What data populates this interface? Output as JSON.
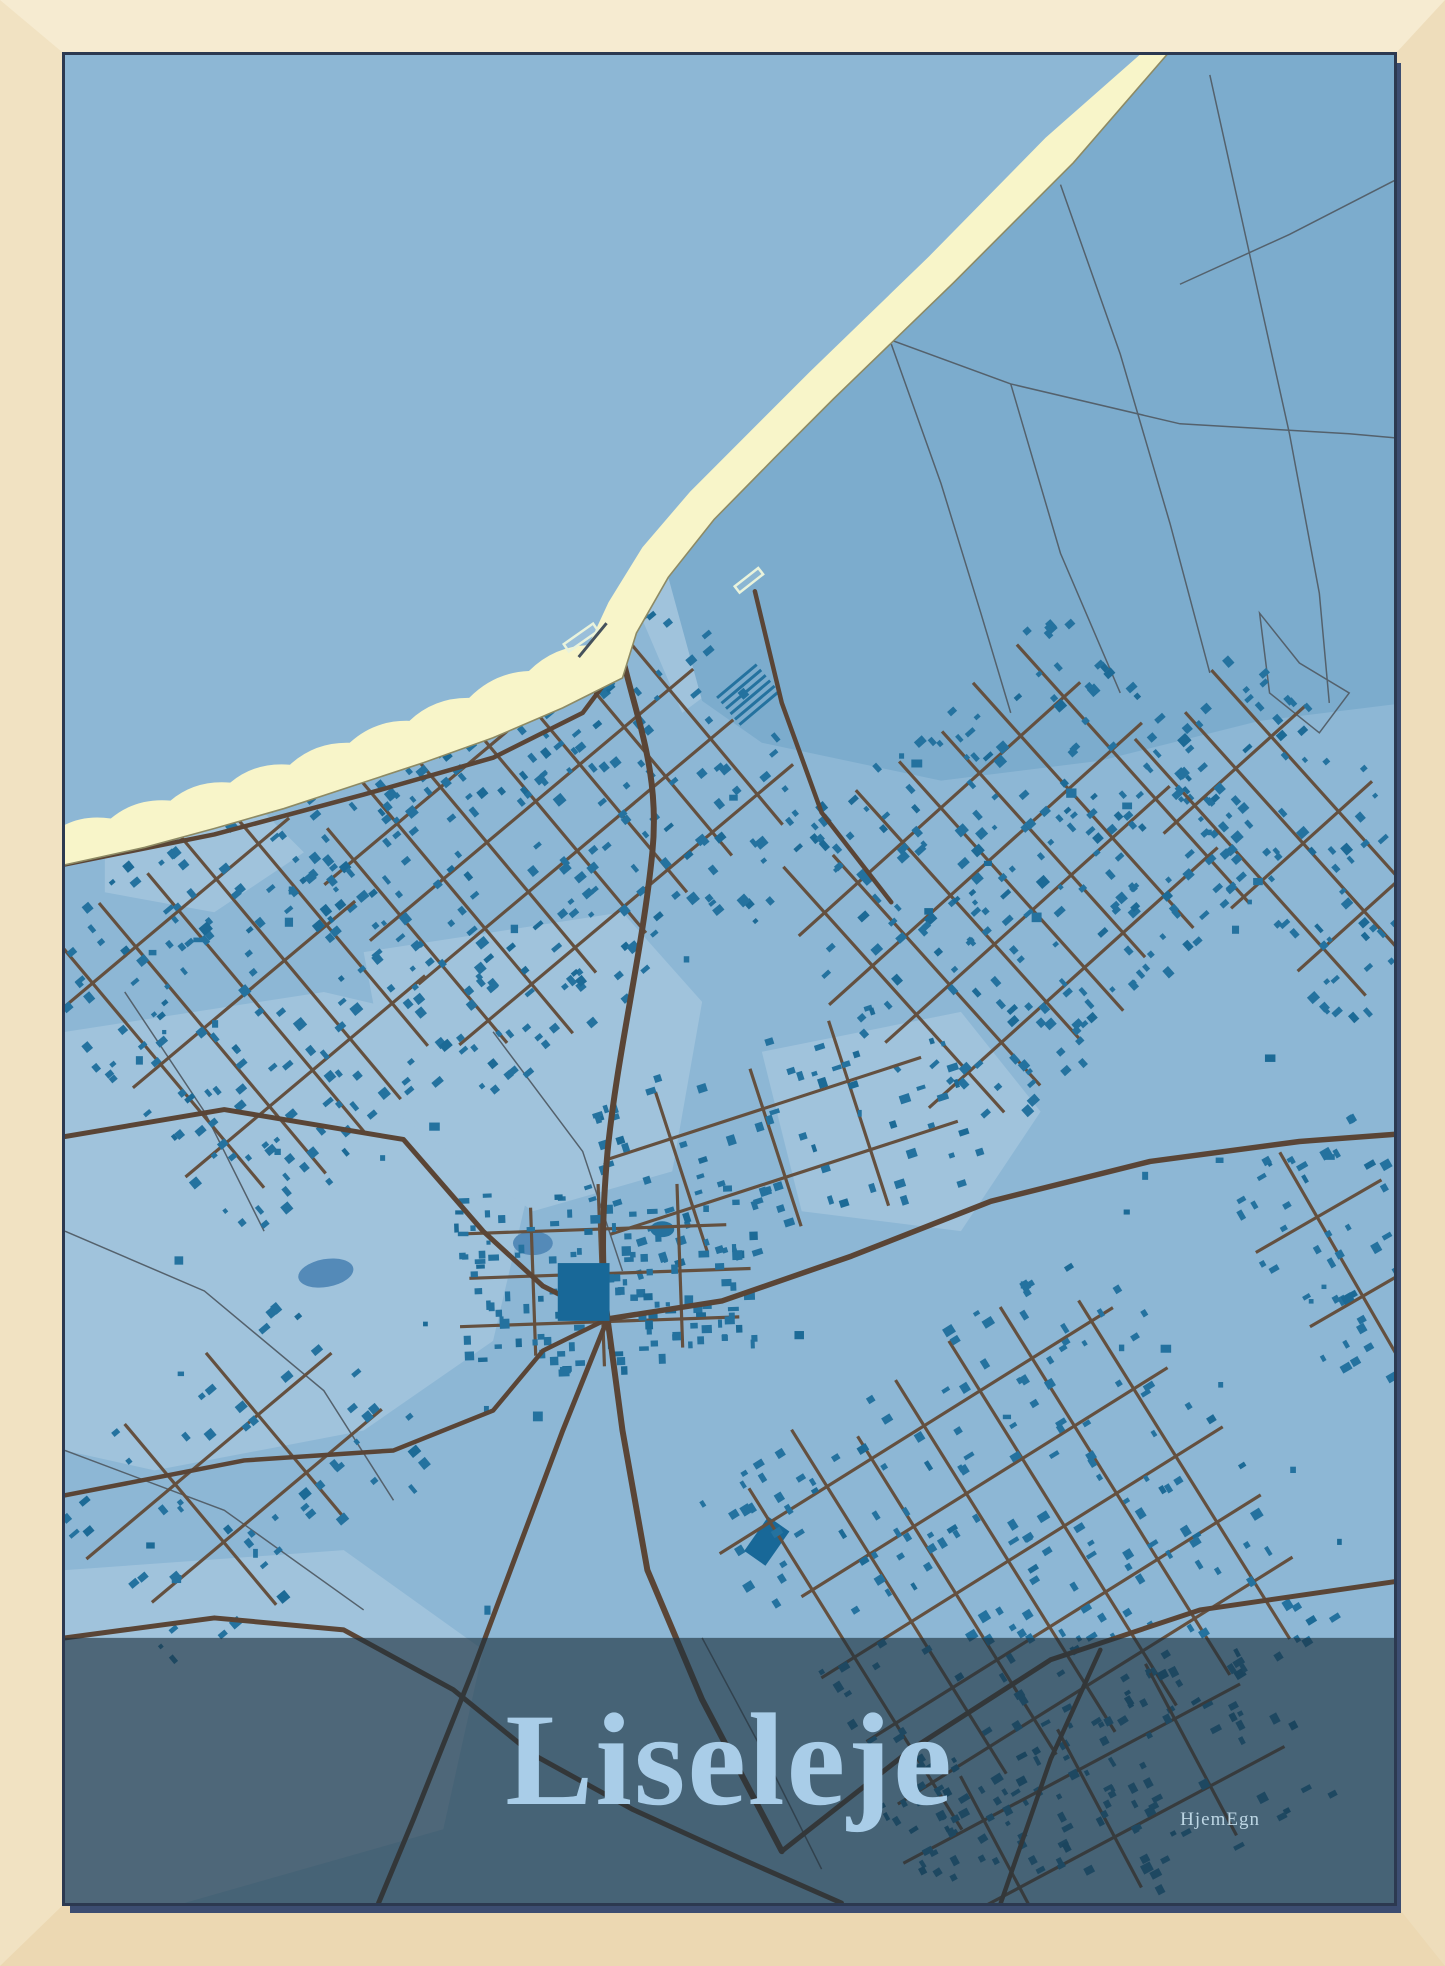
{
  "poster": {
    "title": "Liseleje",
    "brand": "HjemEgn"
  },
  "palette": {
    "sea": "#4e7dab",
    "beach": "#f8f5c9",
    "beach_line": "#8d8a64",
    "land": "#8db7d5",
    "land_light": "#a0c3dc",
    "dune": "#7caccd",
    "path": "#54616c",
    "building": "#24729f",
    "building_dark": "#1c6a96",
    "road": "#5a4536",
    "road_minor": "#64503f",
    "pond": "#548ab8",
    "pond_dark": "#186898",
    "overlay": "rgba(28,46,60,0.62)",
    "title_text": "#a9cde8",
    "logo_text": "#bdd6e4",
    "wood_top": "#f6ebd1",
    "wood_left": "#f1e2c2",
    "wood_right": "#eeddbb",
    "wood_bottom": "#ecd8b2",
    "poster_edge": "#2c3950",
    "poster_shadow": "#3c4d71"
  }
}
